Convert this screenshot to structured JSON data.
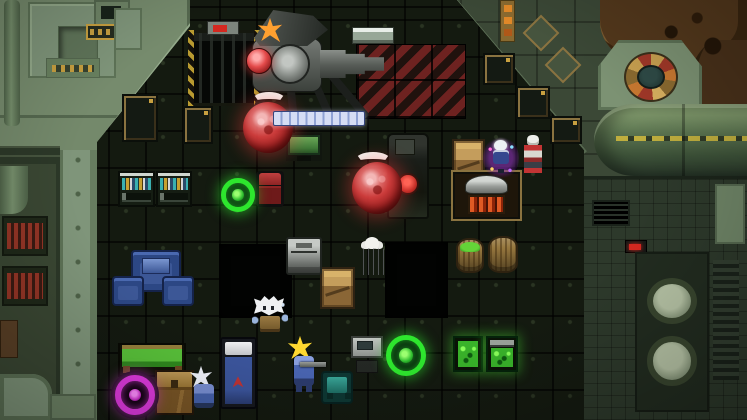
{
  "meta": {
    "scene": "top-down pixel-art space-station interior with dark tiled floor, sage-green machinery walls, enemies and furniture",
    "viewport": {
      "width": 747,
      "height": 420
    }
  },
  "palette": {
    "floor": "#11160e",
    "wall": "#74896b",
    "walldark": "#3b4836",
    "pgreen": "#2ee62e",
    "pmag": "#e03ae0",
    "hazred": "#6e2220",
    "orbred": "#c23232",
    "barfill": "#d5ddf4",
    "barseg": "#8fa2d4",
    "ledred": "#d42820",
    "gold": "#c8a040"
  },
  "scene": {
    "tile_size": 37,
    "grid_offset_x": 34,
    "grid_offset_y": 8
  },
  "hud": {
    "charge_bar": {
      "segments": 11,
      "state": "full",
      "color": "#d5ddf4"
    }
  },
  "entities": {
    "hazard-zone": {
      "box": [
        356,
        44,
        110,
        75
      ],
      "kind": "hazard-floor"
    },
    "shelf-vent": {
      "box": [
        352,
        27,
        42,
        17
      ],
      "kind": "wall-vent"
    },
    "pit-1": {
      "box": [
        219,
        244,
        73,
        74
      ],
      "kind": "pit"
    },
    "pit-2": {
      "box": [
        385,
        242,
        63,
        76
      ],
      "kind": "pit"
    },
    "locker-diag-1": {
      "box": [
        483,
        53,
        32,
        32
      ],
      "kind": "locker"
    },
    "locker-diag-2": {
      "box": [
        516,
        86,
        34,
        33
      ],
      "kind": "locker"
    },
    "locker-diag-3": {
      "box": [
        550,
        116,
        32,
        28
      ],
      "kind": "locker"
    },
    "locker-floor-1": {
      "box": [
        122,
        94,
        36,
        48
      ],
      "kind": "locker"
    },
    "locker-floor-2": {
      "box": [
        183,
        106,
        30,
        38
      ],
      "kind": "locker"
    },
    "server-rack": {
      "box": [
        188,
        30,
        72,
        76
      ],
      "kind": "machine"
    },
    "turret-robot": {
      "box": [
        236,
        10,
        150,
        112
      ],
      "kind": "enemy-turret"
    },
    "crescent-1": {
      "box": [
        252,
        92,
        34,
        17
      ],
      "kind": "enemy-part"
    },
    "orb-red-1": {
      "box": [
        243,
        102,
        50,
        51
      ],
      "kind": "enemy-orb"
    },
    "charge-bar": {
      "box": [
        273,
        111,
        92,
        15
      ],
      "kind": "hud-bar"
    },
    "crescent-2": {
      "box": [
        355,
        152,
        36,
        17
      ],
      "kind": "enemy-part"
    },
    "orb-red-2": {
      "box": [
        352,
        162,
        50,
        52
      ],
      "kind": "enemy-orb"
    },
    "console-green": {
      "box": [
        286,
        133,
        36,
        28
      ],
      "kind": "console"
    },
    "reactor": {
      "box": [
        387,
        133,
        42,
        86
      ],
      "kind": "machine"
    },
    "crate-wood-1": {
      "box": [
        452,
        139,
        33,
        46
      ],
      "kind": "crate"
    },
    "npc-aura-skeleton": {
      "box": [
        483,
        136,
        36,
        44
      ],
      "kind": "npc"
    },
    "npc-red-skeleton": {
      "box": [
        518,
        135,
        30,
        46
      ],
      "kind": "npc"
    },
    "furnace": {
      "box": [
        451,
        170,
        71,
        51
      ],
      "kind": "machine"
    },
    "bookshelf-1": {
      "box": [
        118,
        171,
        37,
        36
      ],
      "kind": "furniture"
    },
    "bookshelf-2": {
      "box": [
        156,
        171,
        36,
        36
      ],
      "kind": "furniture"
    },
    "portal-green-1": {
      "box": [
        221,
        178,
        34,
        34
      ],
      "kind": "portal"
    },
    "chair-red": {
      "box": [
        256,
        171,
        28,
        36
      ],
      "kind": "furniture"
    },
    "sofa-blue-top": {
      "box": [
        131,
        250,
        50,
        42
      ],
      "kind": "furniture"
    },
    "sofa-blue-left": {
      "box": [
        112,
        276,
        32,
        30
      ],
      "kind": "furniture"
    },
    "sofa-blue-right": {
      "box": [
        162,
        276,
        32,
        30
      ],
      "kind": "furniture"
    },
    "chest-metal": {
      "box": [
        286,
        237,
        36,
        38
      ],
      "kind": "container"
    },
    "crate-wood-2": {
      "box": [
        320,
        267,
        35,
        42
      ],
      "kind": "crate"
    },
    "npc-robed": {
      "box": [
        357,
        237,
        30,
        38
      ],
      "kind": "npc"
    },
    "barrel-green": {
      "box": [
        456,
        238,
        28,
        35
      ],
      "kind": "barrel"
    },
    "barrel-tan": {
      "box": [
        488,
        236,
        30,
        37
      ],
      "kind": "barrel"
    },
    "monster-yeti": {
      "box": [
        252,
        296,
        36,
        44
      ],
      "kind": "monster"
    },
    "monster-gunner": {
      "box": [
        286,
        334,
        36,
        66
      ],
      "kind": "monster"
    },
    "chair-teal": {
      "box": [
        321,
        371,
        32,
        33
      ],
      "kind": "furniture"
    },
    "machine-grey": {
      "box": [
        351,
        336,
        32,
        37
      ],
      "kind": "machine"
    },
    "portal-green-2": {
      "box": [
        386,
        335,
        40,
        41
      ],
      "kind": "portal"
    },
    "glowbox-1": {
      "box": [
        453,
        336,
        30,
        36
      ],
      "kind": "supply-box"
    },
    "glowbox-2": {
      "box": [
        486,
        336,
        32,
        36
      ],
      "kind": "supply-box"
    },
    "table-green": {
      "box": [
        118,
        343,
        68,
        34
      ],
      "kind": "furniture"
    },
    "portal-magenta": {
      "box": [
        115,
        375,
        40,
        40
      ],
      "kind": "portal"
    },
    "chest-brown": {
      "box": [
        155,
        370,
        39,
        45
      ],
      "kind": "container"
    },
    "monster-sparkle": {
      "box": [
        188,
        366,
        34,
        48
      ],
      "kind": "monster"
    },
    "bed-blue": {
      "box": [
        220,
        337,
        37,
        72
      ],
      "kind": "furniture"
    }
  }
}
